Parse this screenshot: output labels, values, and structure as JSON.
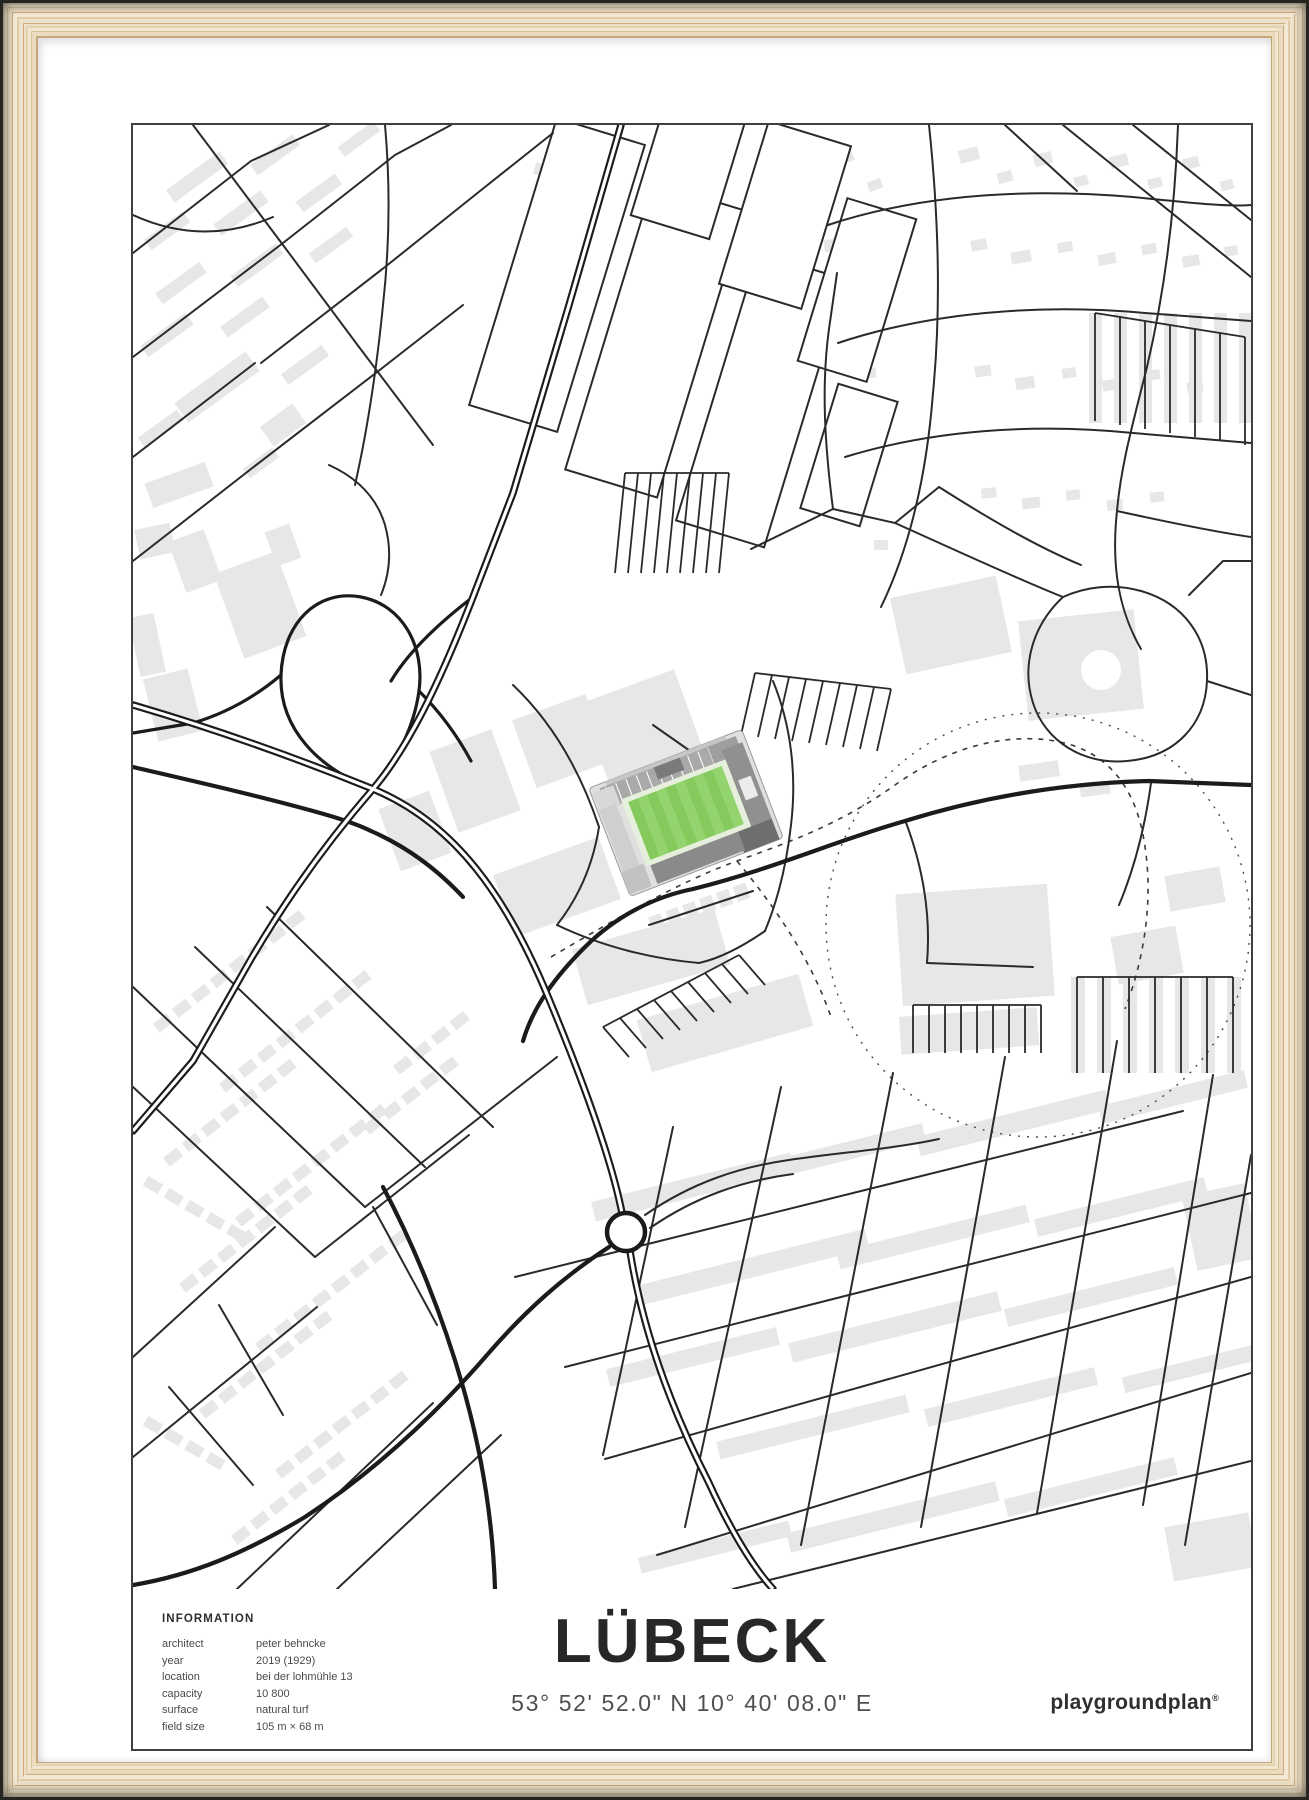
{
  "poster": {
    "title": "LÜBECK",
    "coordinates": "53° 52' 52.0\" N 10° 40' 08.0\" E",
    "brand": {
      "name": "playgroundplan",
      "registered_mark": "®"
    },
    "info": {
      "heading": "INFORMATION",
      "rows": [
        {
          "label": "architect",
          "value": "peter behncke"
        },
        {
          "label": "year",
          "value": "2019 (1929)"
        },
        {
          "label": "location",
          "value": "bei der lohmühle 13"
        },
        {
          "label": "capacity",
          "value": "10 800"
        },
        {
          "label": "surface",
          "value": "natural turf"
        },
        {
          "label": "field size",
          "value": "105 m × 68 m"
        }
      ]
    },
    "colors": {
      "pitch_green": "#84ca5c",
      "pitch_stripe": "#93d46f",
      "stand_dark": "#6e6e6e",
      "building_gray": "#e7e7e7",
      "road_black": "#1b1b1b",
      "frame_wood": "#e9d9bd"
    }
  }
}
